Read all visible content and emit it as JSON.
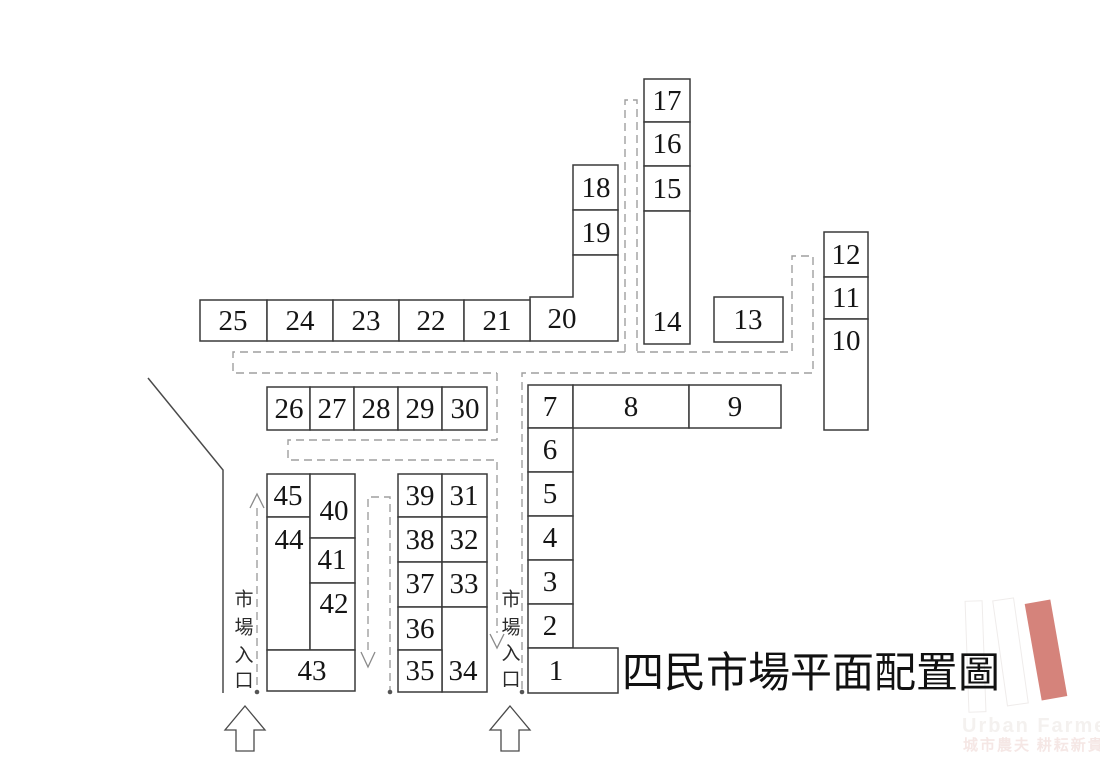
{
  "title": "四民市場平面配置圖",
  "entrance_label": {
    "text": "市場入口",
    "c0": "市",
    "c1": "場",
    "c2": "入",
    "c3": "口"
  },
  "stalls": {
    "s1": "1",
    "s2": "2",
    "s3": "3",
    "s4": "4",
    "s5": "5",
    "s6": "6",
    "s7": "7",
    "s8": "8",
    "s9": "9",
    "s10": "10",
    "s11": "11",
    "s12": "12",
    "s13": "13",
    "s14": "14",
    "s15": "15",
    "s16": "16",
    "s17": "17",
    "s18": "18",
    "s19": "19",
    "s20": "20",
    "s21": "21",
    "s22": "22",
    "s23": "23",
    "s24": "24",
    "s25": "25",
    "s26": "26",
    "s27": "27",
    "s28": "28",
    "s29": "29",
    "s30": "30",
    "s31": "31",
    "s32": "32",
    "s33": "33",
    "s34": "34",
    "s35": "35",
    "s36": "36",
    "s37": "37",
    "s38": "38",
    "s39": "39",
    "s40": "40",
    "s41": "41",
    "s42": "42",
    "s43": "43",
    "s44": "44",
    "s45": "45"
  },
  "logo": {
    "name_en": "Urban Farmer",
    "name_zh": "城市農夫 耕耘新貴",
    "bar_color": "#d5837b"
  },
  "colors": {
    "outline": "#3a3a3a",
    "walkway_dash": "#9f9f9f"
  }
}
